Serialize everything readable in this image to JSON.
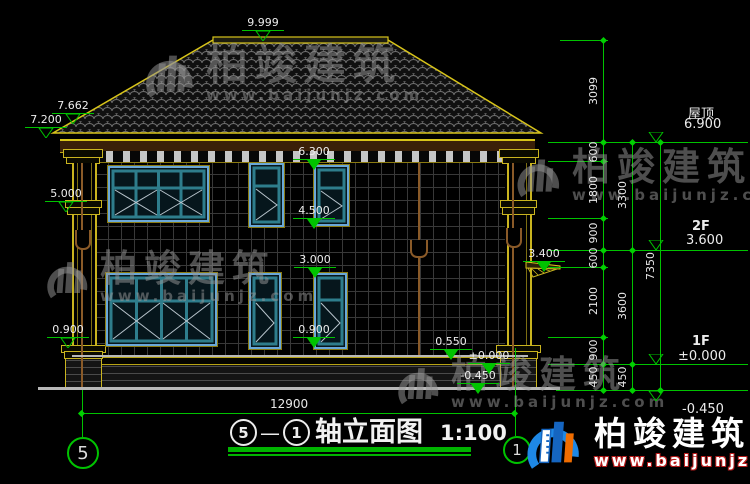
{
  "watermark": {
    "name": "柏竣建筑",
    "url": "www.baijunjz.com"
  },
  "title": {
    "axis_from": "5",
    "sep": "—",
    "axis_to": "1",
    "name": "轴立面图",
    "scale": "1:100"
  },
  "axis_bubbles": {
    "left": "5",
    "right": "1"
  },
  "bottom_dim": "12900",
  "levels": {
    "ridge": "9.999",
    "roof_upper": "7.662",
    "eave": "7.200",
    "col_band": "5.000",
    "sill_left": "0.900",
    "wall_top": "6.300",
    "win2f_sill": "4.500",
    "win1f_head": "3.000",
    "sill_mid": "0.900",
    "plinth": "0.550",
    "canopy": "3.400",
    "zero_building": "±0.000",
    "minus_building": "-0.450"
  },
  "right_levels": [
    {
      "label": "屋顶",
      "value": "6.900"
    },
    {
      "label": "2F",
      "value": "3.600"
    },
    {
      "label": "1F",
      "value": "±0.000"
    },
    {
      "label": "",
      "value": "-0.450"
    }
  ],
  "dim_chains": {
    "inner": [
      "3099",
      "600",
      "1800",
      "900",
      "600",
      "2100",
      "900",
      "450"
    ],
    "mid": [
      "3300",
      "3600",
      "450"
    ],
    "outer": [
      "7350"
    ]
  }
}
